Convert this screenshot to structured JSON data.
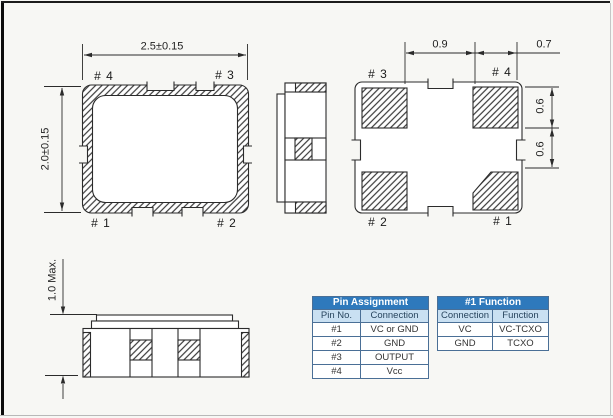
{
  "drawing": {
    "top_view": {
      "dim_width": "2.5±0.15",
      "dim_height": "2.0±0.15",
      "pin_top_left": "# 4",
      "pin_top_right": "# 3",
      "pin_bottom_left": "# 1",
      "pin_bottom_right": "# 2"
    },
    "bottom_view": {
      "dim_pad_pitch": "0.9",
      "dim_pad_width": "0.7",
      "dim_pad_height_upper": "0.6",
      "dim_pad_height_lower": "0.6",
      "pin_top_left": "# 3",
      "pin_top_right": "# 4",
      "pin_bottom_left": "# 2",
      "pin_bottom_right": "# 1"
    },
    "side_view": {
      "dim_height": "1.0 Max."
    }
  },
  "tables": {
    "pin_assignment": {
      "title": "Pin Assignment",
      "columns": [
        "Pin No.",
        "Connection"
      ],
      "rows": [
        [
          "#1",
          "VC or GND"
        ],
        [
          "#2",
          "GND"
        ],
        [
          "#3",
          "OUTPUT"
        ],
        [
          "#4",
          "Vcc"
        ]
      ]
    },
    "pin1_function": {
      "title": "#1 Function",
      "columns": [
        "Connection",
        "Function"
      ],
      "rows": [
        [
          "VC",
          "VC-TCXO"
        ],
        [
          "GND",
          "TCXO"
        ]
      ]
    }
  },
  "colors": {
    "table_header_bg": "#2e79bc",
    "table_header_text": "#ffffff",
    "table_subheader_bg": "#c9e0f2",
    "table_border": "#4a6f96",
    "line_color": "#2b2b2b",
    "page_bg": "#f7f7f4"
  }
}
